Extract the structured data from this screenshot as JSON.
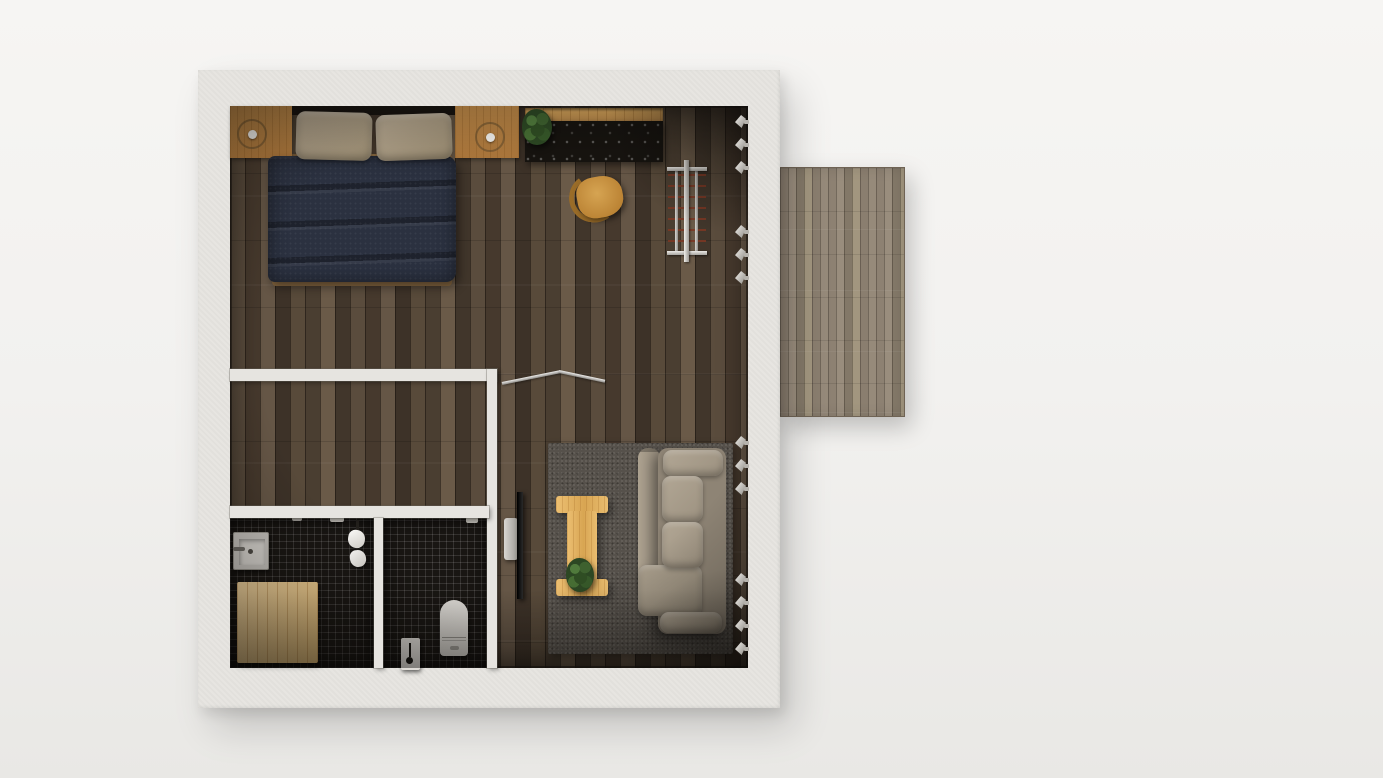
{
  "scene": {
    "title": "Top-down 3D render of a small studio apartment floor plan with an outdoor deck",
    "view": "top-down"
  },
  "colors": {
    "wall": "#e6e4e0",
    "floor-base": "#4e4336",
    "deck-base": "#94897b",
    "tile-base": "#191613",
    "bed-duvet": "#2b3140",
    "pillow": "#a59781",
    "headboard-wood": "#b3803f",
    "shelf-wood": "#c79a58",
    "counter-top": "#16130f",
    "chair-wood": "#c69140",
    "rug": "#56514b",
    "sofa": "#a89d8c",
    "table-wood": "#e3b468",
    "mat-wood": "#eac37d",
    "plant-green": "#2f4d27",
    "metal": "#c9c8c5",
    "porcelain": "#dad7d2"
  },
  "rooms": {
    "main": {
      "label": "Open bedroom / living area with dark plank flooring"
    },
    "closet": {
      "label": "Empty inner room (walk-in closet)"
    },
    "bath": {
      "label": "Shower bathroom with black mosaic tiles"
    },
    "wc": {
      "label": "Toilet room with black mosaic tiles"
    },
    "deck": {
      "label": "Outdoor wooden deck"
    }
  },
  "furniture": {
    "bed": {
      "label": "Double bed with dark navy duvet"
    },
    "bed_frame": {
      "label": "Wooden bed frame"
    },
    "pillow_left": {
      "label": "Pillow"
    },
    "pillow_right": {
      "label": "Pillow"
    },
    "nightstand_left": {
      "label": "Built-in headboard nightstand"
    },
    "nightstand_right": {
      "label": "Built-in headboard nightstand"
    },
    "reading_light_left": {
      "label": "Recessed reading light"
    },
    "reading_light_right": {
      "label": "Recessed reading light"
    },
    "headboard": {
      "label": "Headboard shelf gap"
    },
    "desk_shelf": {
      "label": "Wooden wall shelf above desk"
    },
    "desk": {
      "label": "Black stone desk counter"
    },
    "desk_plant": {
      "label": "Potted plant"
    },
    "chair": {
      "label": "Wooden chair"
    },
    "clothes_rack": {
      "label": "Metal clothes drying rack"
    },
    "hanging_rail": {
      "label": "Angled metal hanging rail"
    },
    "tv": {
      "label": "Flat-screen TV"
    },
    "tv_stand": {
      "label": "TV floor stand"
    },
    "rug": {
      "label": "Dark gray area rug"
    },
    "coffee_table": {
      "label": "I-shaped wooden coffee table"
    },
    "table_plant": {
      "label": "Potted plant on coffee table"
    },
    "sofa": {
      "label": "Beige three-seat sofa with chaise"
    },
    "sofa_chaise": {
      "label": "Sofa chaise / ottoman section"
    },
    "sink": {
      "label": "Square washbasin"
    },
    "sink_faucet": {
      "label": "Basin faucet"
    },
    "shower_mat": {
      "label": "Light wooden shower mat"
    },
    "shower_head": {
      "label": "Shower head"
    },
    "shower_mixer": {
      "label": "Shower mixer"
    },
    "towel_rail": {
      "label": "Towel rail with white towels"
    },
    "toilet": {
      "label": "Toilet"
    },
    "toilet_brush": {
      "label": "Toilet brush stand"
    },
    "tp_holder": {
      "label": "Toilet paper holder"
    },
    "wall_spotlight": {
      "label": "Wall-mounted spotlight"
    }
  },
  "lighting": {
    "spotlight_groups": [
      {
        "count": 3
      },
      {
        "count": 3
      },
      {
        "count": 3
      },
      {
        "count": 4
      }
    ]
  }
}
